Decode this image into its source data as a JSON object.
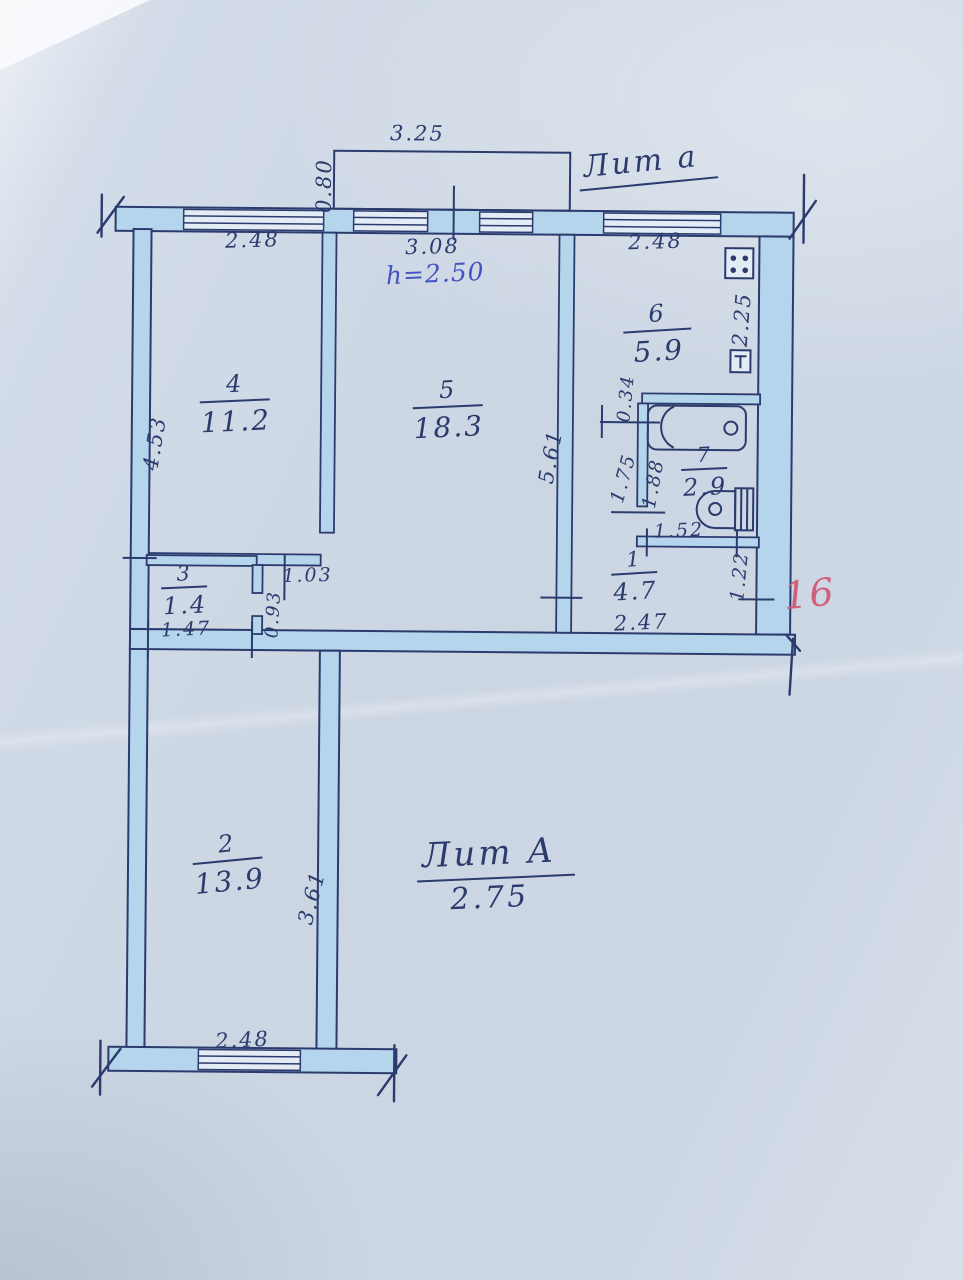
{
  "document": {
    "type": "apartment floor plan (technical passport sheet)",
    "colors": {
      "ink": "#2c3b6e",
      "wall_fill": "#b5d5ec",
      "paper": "#ccd6e3",
      "pen_blue": "#4353c2",
      "mark_red": "#cf5f7a"
    }
  },
  "annotations": {
    "building_letter_top": "Лит а",
    "ceiling_height": "h=2.50",
    "building_letter_main": "Лит А",
    "building_height": "2.75",
    "plot_number": "16"
  },
  "rooms": {
    "room1": {
      "number": "1",
      "area": "4.7"
    },
    "room2": {
      "number": "2",
      "area": "13.9"
    },
    "room3": {
      "number": "3",
      "area": "1.4"
    },
    "room4": {
      "number": "4",
      "area": "11.2"
    },
    "room5": {
      "number": "5",
      "area": "18.3"
    },
    "room6": {
      "number": "6",
      "area": "5.9"
    },
    "room7": {
      "number": "7",
      "area": "2.9"
    }
  },
  "dimensions": {
    "balcony_width": "3.25",
    "balcony_depth": "0.80",
    "top_window_left": "2.48",
    "top_window_center": "3.08",
    "top_window_right": "2.48",
    "left_side": "4.53",
    "room5_side": "5.61",
    "kitchen_side": "2.25",
    "kitchen_door": "0.34",
    "passage_left": "1.75",
    "passage_right": "1.88",
    "bathroom_width": "1.52",
    "hall_side": "1.22",
    "hall_width": "2.47",
    "room4_door": "1.03",
    "closet_side": "0.93",
    "closet_width": "1.47",
    "room2_side": "3.61",
    "room2_window": "2.48"
  },
  "icons": {
    "stove": "stove-icon",
    "boiler": "boiler-icon",
    "bathtub": "bathtub-icon",
    "toilet": "toilet-icon"
  }
}
